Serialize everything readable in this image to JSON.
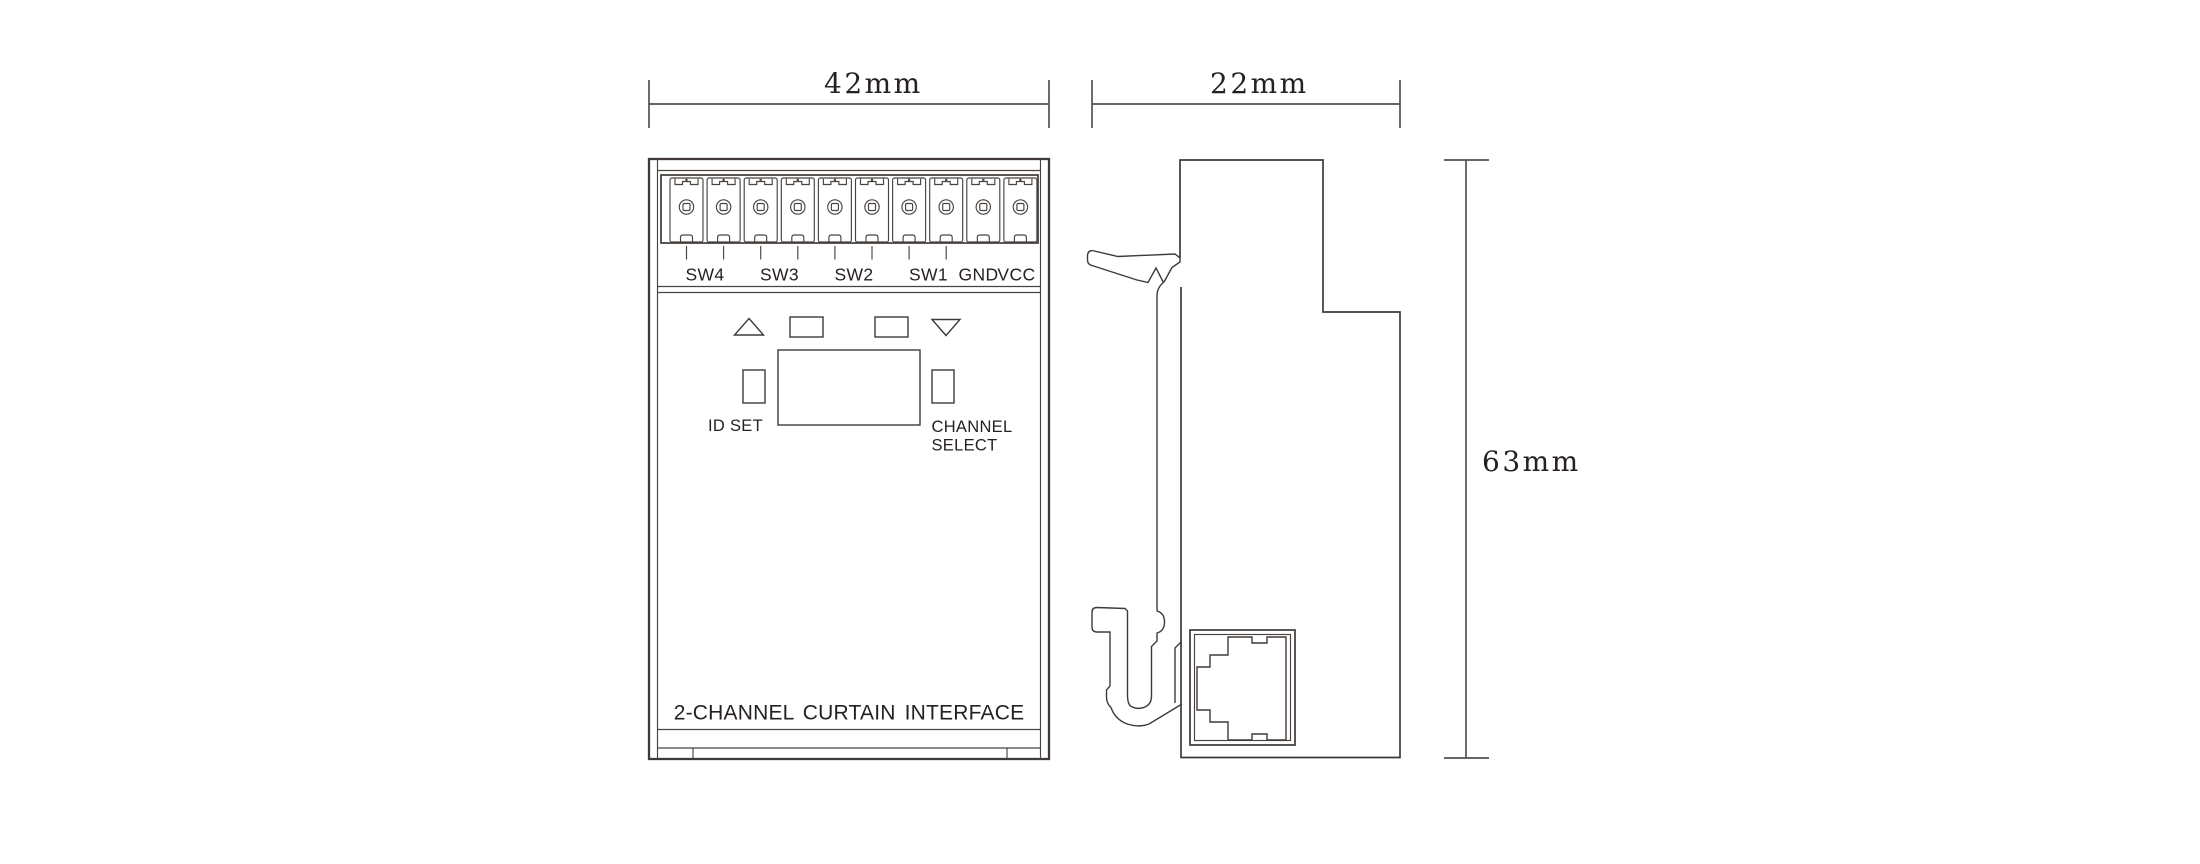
{
  "drawing": {
    "front_view": {
      "terminal_count": 10,
      "terminal_labels": [
        "SW4",
        "SW3",
        "SW2",
        "SW1",
        "GND",
        "VCC"
      ],
      "id_set_label": "ID SET",
      "channel_select_label_line1": "CHANNEL",
      "channel_select_label_line2": "SELECT",
      "bottom_label": "2-CHANNEL CURTAIN INTERFACE"
    },
    "dimensions": {
      "front_width": "42mm",
      "side_width": "22mm",
      "height": "63mm"
    },
    "colors": {
      "background": "#ffffff",
      "device_line": "#3f3a37",
      "dimension_line": "#56514d",
      "text": "#26211e"
    }
  }
}
